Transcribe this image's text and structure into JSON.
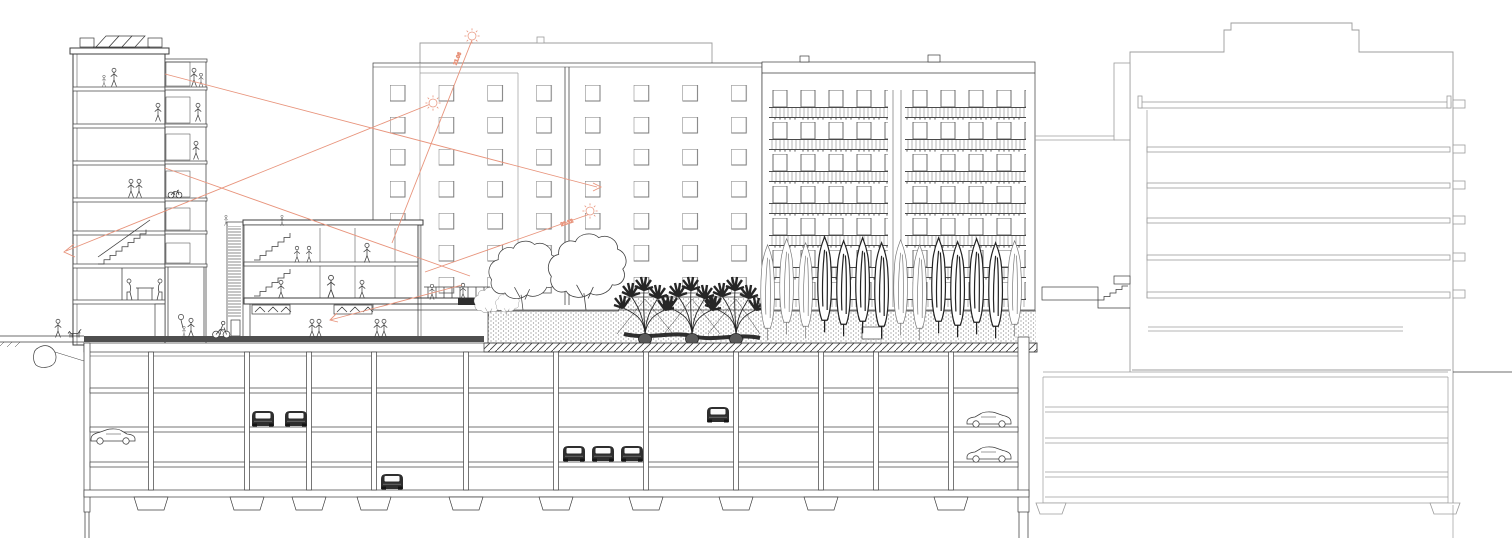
{
  "colors": {
    "background": "#ffffff",
    "ink": "#3d3d3d",
    "light_ink": "#9c9c9c",
    "accent": "#e8947c",
    "street_fill": "#4f4f4f",
    "dark_fill": "#2e2e2e",
    "soil_dot": "#8f8f8f"
  },
  "annotations": {
    "summer_sun_label": "21.06",
    "winter_sun_label": "21.12"
  },
  "scene": {
    "type": "architectural cross-section drawing",
    "buildings": [
      {
        "name": "stair-tower",
        "floors_above_ground": 6,
        "rooftop": "solar-panels",
        "side": "external-stair-with-louvres"
      },
      {
        "name": "terrace-house",
        "floors_above_ground": 2,
        "rooftop": "roof-terrace"
      },
      {
        "name": "mid-rise-slab",
        "floors_above_ground": 7,
        "facade": "square-window-grid"
      },
      {
        "name": "balcony-slab",
        "floors_above_ground": 7,
        "facade": "balconies-with-railings"
      },
      {
        "name": "right-section-building",
        "floors_above_ground": 6,
        "basement_levels": 4,
        "rooftop": "stepped-parapet"
      }
    ],
    "underground_parking": {
      "levels": 4,
      "cars_side_view": 4,
      "cars_rear_view": 6
    },
    "podium_garden": {
      "round_canopy_trees": 4,
      "multi_stem_trees": 3,
      "columnar_trees": 14,
      "soil_bed": true,
      "root_balls": 3
    },
    "figures": {
      "people": 29,
      "dog": 1,
      "cyclist": 1,
      "parked_bicycle": 1
    },
    "sun_symbols": 3,
    "sight_lines": 6
  }
}
